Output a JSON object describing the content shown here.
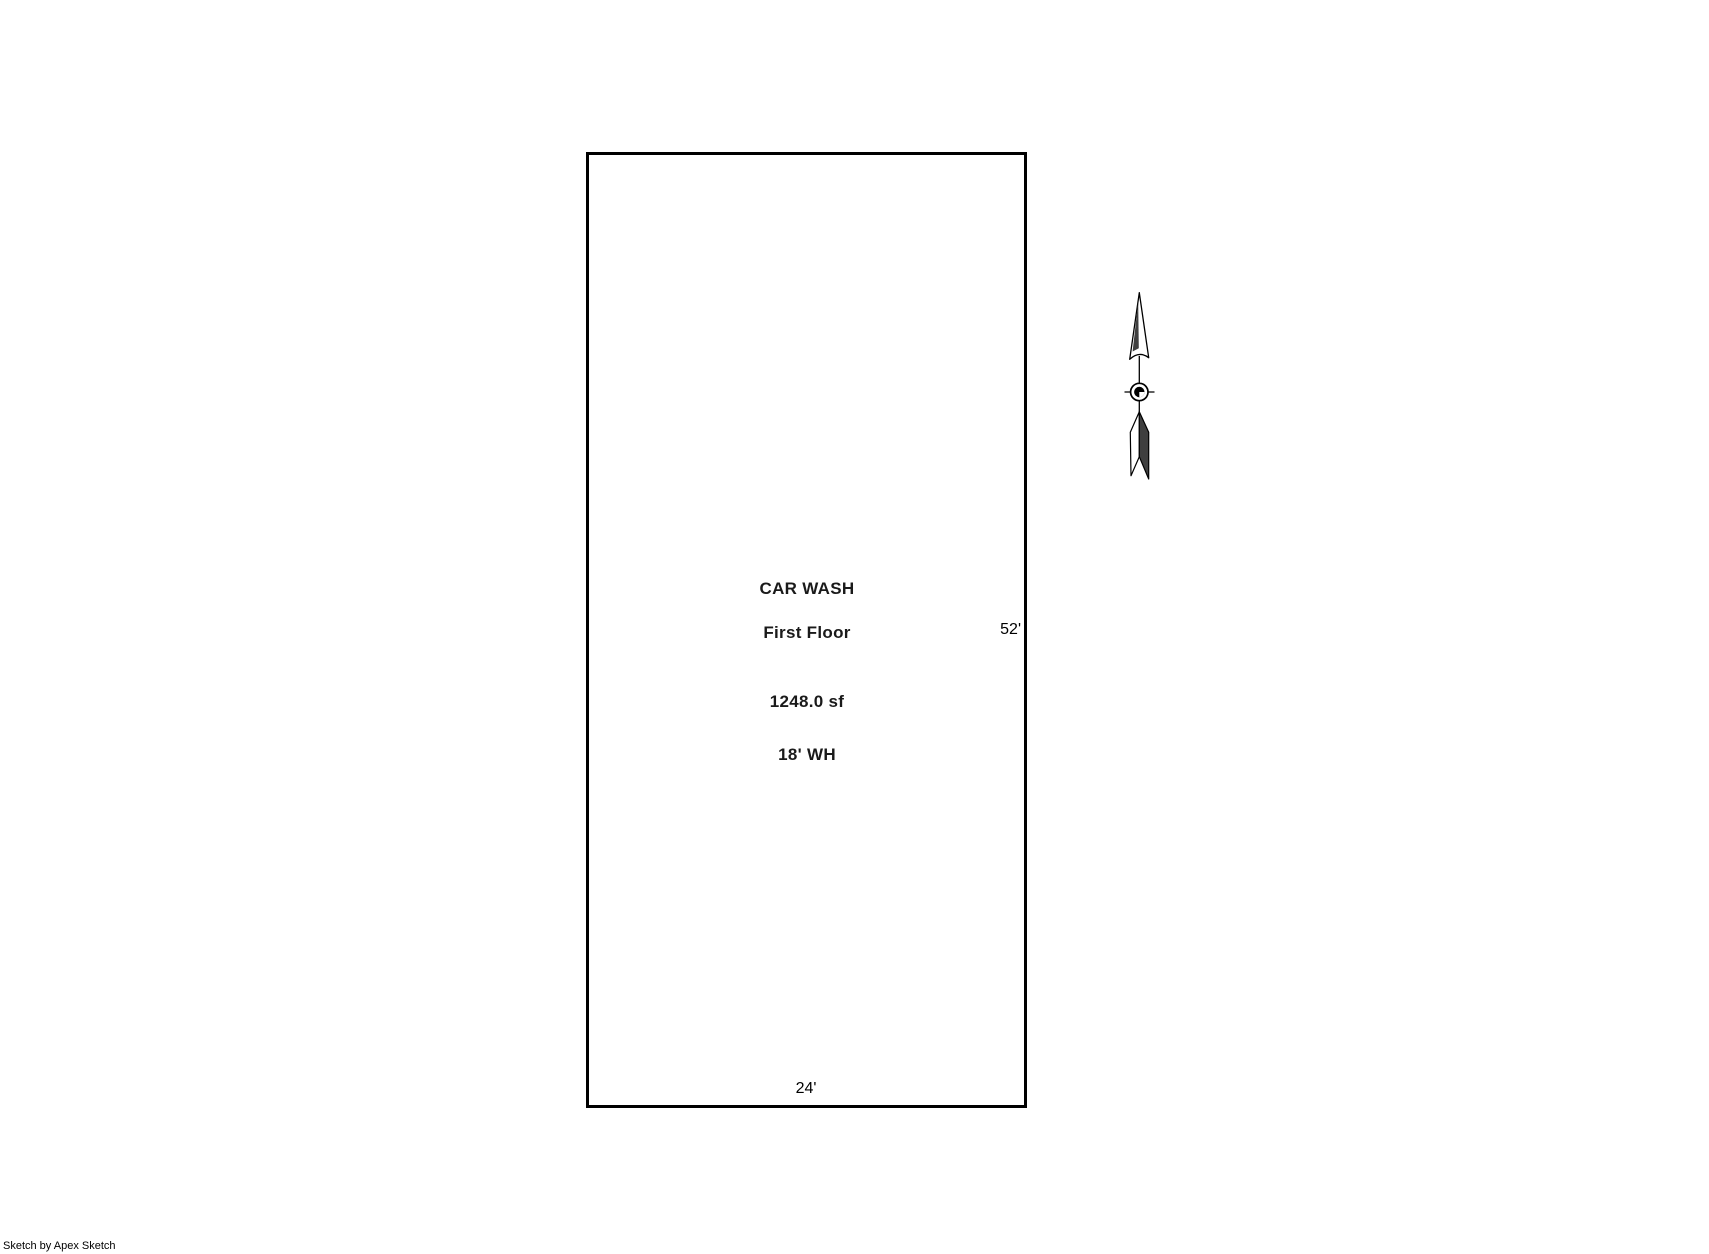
{
  "colors": {
    "background": "#ffffff",
    "outline": "#000000",
    "label_text": "#1a1a1a",
    "arrow_dark_fill": "#3f3f3f"
  },
  "floorplan": {
    "labels": {
      "title": "CAR WASH",
      "floor": "First Floor",
      "area": "1248.0 sf",
      "wall_height": "18' WH"
    },
    "dimensions": {
      "right_wall": "52'",
      "bottom_wall": "24'"
    }
  },
  "north_arrow": {
    "icon": "north-arrow-icon"
  },
  "footer": {
    "credit": "Sketch by Apex Sketch"
  }
}
